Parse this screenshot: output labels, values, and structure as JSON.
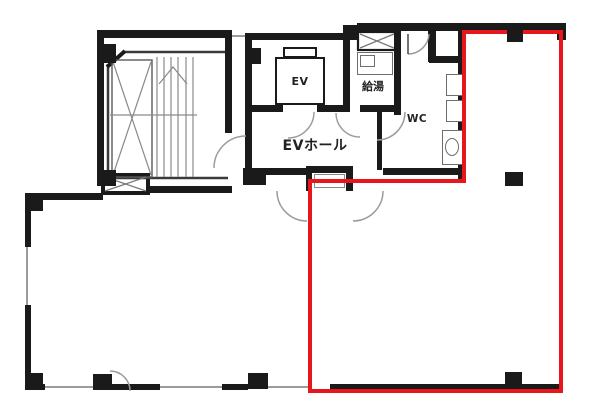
{
  "floor_plan": {
    "room_labels": {
      "elevator": "EV",
      "elevator_hall": "EVホール",
      "hot_water": "給湯",
      "toilet": "WC"
    }
  },
  "colors": {
    "highlight_red": "#e8151c",
    "wall_black": "#1a1a1a",
    "detail_gray": "#9b9b9b"
  }
}
